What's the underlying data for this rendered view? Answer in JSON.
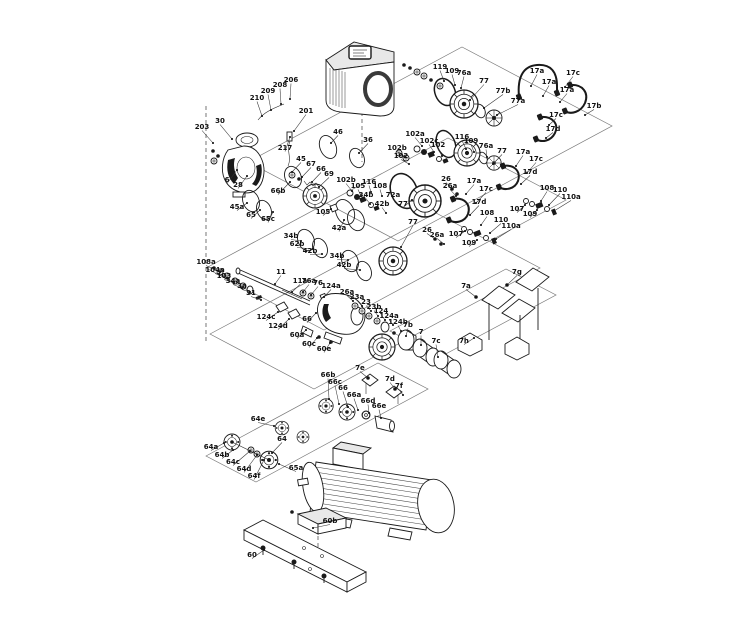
{
  "figure": {
    "type": "exploded_parts_diagram",
    "subject": "Multistage pump exploded view with numbered part callouts",
    "background": "#ffffff",
    "line_color": "#1a1a1a",
    "label_color": "#111111",
    "label_font_size": 7
  },
  "callouts": [
    {
      "t": "203",
      "x": 202,
      "y": 129,
      "lx": 213,
      "ly": 143
    },
    {
      "t": "30",
      "x": 220,
      "y": 123,
      "lx": 232,
      "ly": 139
    },
    {
      "t": "210",
      "x": 257,
      "y": 100,
      "lx": 262,
      "ly": 116
    },
    {
      "t": "209",
      "x": 268,
      "y": 93,
      "lx": 271,
      "ly": 110
    },
    {
      "t": "208",
      "x": 280,
      "y": 87,
      "lx": 281,
      "ly": 104
    },
    {
      "t": "206",
      "x": 291,
      "y": 82,
      "lx": 290,
      "ly": 99
    },
    {
      "t": "201",
      "x": 306,
      "y": 113,
      "lx": 294,
      "ly": 131
    },
    {
      "t": "217",
      "x": 285,
      "y": 150,
      "lx": 290,
      "ly": 137
    },
    {
      "t": "6",
      "x": 227,
      "y": 182,
      "lx": 237,
      "ly": 170
    },
    {
      "t": "28",
      "x": 238,
      "y": 187,
      "lx": 247,
      "ly": 176
    },
    {
      "t": "46",
      "x": 338,
      "y": 134,
      "lx": 331,
      "ly": 143
    },
    {
      "t": "36",
      "x": 368,
      "y": 142,
      "lx": 359,
      "ly": 153
    },
    {
      "t": "45",
      "x": 301,
      "y": 161,
      "lx": 292,
      "ly": 172
    },
    {
      "t": "67",
      "x": 311,
      "y": 166,
      "lx": 302,
      "ly": 177
    },
    {
      "t": "66",
      "x": 321,
      "y": 171,
      "lx": 312,
      "ly": 182
    },
    {
      "t": "69",
      "x": 329,
      "y": 176,
      "lx": 319,
      "ly": 187
    },
    {
      "t": "66b",
      "x": 278,
      "y": 193,
      "lx": 290,
      "ly": 182
    },
    {
      "t": "45a",
      "x": 237,
      "y": 209,
      "lx": 247,
      "ly": 203
    },
    {
      "t": "65",
      "x": 251,
      "y": 217,
      "lx": 260,
      "ly": 210
    },
    {
      "t": "65c",
      "x": 268,
      "y": 221,
      "lx": 273,
      "ly": 212
    },
    {
      "t": "34b",
      "x": 291,
      "y": 238,
      "lx": 301,
      "ly": 241
    },
    {
      "t": "62b",
      "x": 297,
      "y": 246,
      "lx": 313,
      "ly": 249
    },
    {
      "t": "42b",
      "x": 310,
      "y": 253,
      "lx": 322,
      "ly": 254
    },
    {
      "t": "34b",
      "x": 337,
      "y": 258,
      "lx": 348,
      "ly": 260
    },
    {
      "t": "42b",
      "x": 344,
      "y": 267,
      "lx": 360,
      "ly": 270
    },
    {
      "t": "105",
      "x": 323,
      "y": 214,
      "lx": 331,
      "ly": 209
    },
    {
      "t": "102b",
      "x": 346,
      "y": 182,
      "lx": 352,
      "ly": 191
    },
    {
      "t": "105",
      "x": 358,
      "y": 188,
      "lx": 361,
      "ly": 196
    },
    {
      "t": "116",
      "x": 369,
      "y": 184,
      "lx": 371,
      "ly": 192
    },
    {
      "t": "108",
      "x": 380,
      "y": 188,
      "lx": 382,
      "ly": 196
    },
    {
      "t": "34b",
      "x": 366,
      "y": 197,
      "lx": 370,
      "ly": 204
    },
    {
      "t": "42b",
      "x": 382,
      "y": 206,
      "lx": 386,
      "ly": 213
    },
    {
      "t": "72a",
      "x": 393,
      "y": 197,
      "lx": 399,
      "ly": 205
    },
    {
      "t": "42a",
      "x": 339,
      "y": 230,
      "lx": 344,
      "ly": 220
    },
    {
      "t": "77",
      "x": 403,
      "y": 206,
      "lx": 412,
      "ly": 200
    },
    {
      "t": "77",
      "x": 413,
      "y": 224,
      "lx": 401,
      "ly": 247
    },
    {
      "t": "26",
      "x": 446,
      "y": 181,
      "lx": 452,
      "ly": 189
    },
    {
      "t": "26a",
      "x": 450,
      "y": 188,
      "lx": 456,
      "ly": 196
    },
    {
      "t": "17a",
      "x": 474,
      "y": 183,
      "lx": 466,
      "ly": 194
    },
    {
      "t": "17c",
      "x": 486,
      "y": 191,
      "lx": 476,
      "ly": 203
    },
    {
      "t": "17d",
      "x": 479,
      "y": 204,
      "lx": 470,
      "ly": 215
    },
    {
      "t": "26",
      "x": 427,
      "y": 232,
      "lx": 435,
      "ly": 239
    },
    {
      "t": "26a",
      "x": 437,
      "y": 237,
      "lx": 444,
      "ly": 244
    },
    {
      "t": "107",
      "x": 456,
      "y": 236,
      "lx": 465,
      "ly": 231
    },
    {
      "t": "109",
      "x": 469,
      "y": 245,
      "lx": 477,
      "ly": 240
    },
    {
      "t": "108",
      "x": 487,
      "y": 215,
      "lx": 481,
      "ly": 225
    },
    {
      "t": "110",
      "x": 501,
      "y": 222,
      "lx": 490,
      "ly": 233
    },
    {
      "t": "110a",
      "x": 511,
      "y": 228,
      "lx": 496,
      "ly": 239
    },
    {
      "t": "102b",
      "x": 397,
      "y": 150,
      "lx": 405,
      "ly": 157
    },
    {
      "t": "102",
      "x": 401,
      "y": 158,
      "lx": 409,
      "ly": 164
    },
    {
      "t": "102a",
      "x": 415,
      "y": 136,
      "lx": 422,
      "ly": 146
    },
    {
      "t": "102c",
      "x": 429,
      "y": 143,
      "lx": 434,
      "ly": 152
    },
    {
      "t": "102",
      "x": 438,
      "y": 147,
      "lx": 442,
      "ly": 156
    },
    {
      "t": "116",
      "x": 462,
      "y": 139,
      "lx": 466,
      "ly": 149
    },
    {
      "t": "109",
      "x": 471,
      "y": 143,
      "lx": 474,
      "ly": 152
    },
    {
      "t": "76a",
      "x": 486,
      "y": 148,
      "lx": 487,
      "ly": 157
    },
    {
      "t": "77",
      "x": 502,
      "y": 153,
      "lx": 493,
      "ly": 164
    },
    {
      "t": "17a",
      "x": 523,
      "y": 154,
      "lx": 516,
      "ly": 166
    },
    {
      "t": "17c",
      "x": 536,
      "y": 161,
      "lx": 527,
      "ly": 173
    },
    {
      "t": "17d",
      "x": 530,
      "y": 174,
      "lx": 521,
      "ly": 184
    },
    {
      "t": "107",
      "x": 517,
      "y": 211,
      "lx": 525,
      "ly": 205
    },
    {
      "t": "109",
      "x": 530,
      "y": 216,
      "lx": 537,
      "ly": 210
    },
    {
      "t": "108",
      "x": 547,
      "y": 190,
      "lx": 541,
      "ly": 201
    },
    {
      "t": "110",
      "x": 560,
      "y": 192,
      "lx": 549,
      "ly": 205
    },
    {
      "t": "110a",
      "x": 571,
      "y": 199,
      "lx": 554,
      "ly": 211
    },
    {
      "t": "119",
      "x": 440,
      "y": 69,
      "lx": 444,
      "ly": 81
    },
    {
      "t": "109",
      "x": 452,
      "y": 73,
      "lx": 455,
      "ly": 85
    },
    {
      "t": "76a",
      "x": 464,
      "y": 75,
      "lx": 461,
      "ly": 88
    },
    {
      "t": "77",
      "x": 484,
      "y": 83,
      "lx": 470,
      "ly": 100
    },
    {
      "t": "77b",
      "x": 503,
      "y": 93,
      "lx": 484,
      "ly": 108
    },
    {
      "t": "77a",
      "x": 518,
      "y": 103,
      "lx": 497,
      "ly": 115
    },
    {
      "t": "17a",
      "x": 537,
      "y": 73,
      "lx": 531,
      "ly": 86
    },
    {
      "t": "17c",
      "x": 573,
      "y": 75,
      "lx": 565,
      "ly": 87
    },
    {
      "t": "17a",
      "x": 549,
      "y": 84,
      "lx": 543,
      "ly": 96
    },
    {
      "t": "17b",
      "x": 594,
      "y": 108,
      "lx": 585,
      "ly": 115
    },
    {
      "t": "17a",
      "x": 567,
      "y": 92,
      "lx": 560,
      "ly": 102
    },
    {
      "t": "17c",
      "x": 556,
      "y": 117,
      "lx": 549,
      "ly": 125
    },
    {
      "t": "17d",
      "x": 553,
      "y": 131,
      "lx": 546,
      "ly": 138
    },
    {
      "t": "108a",
      "x": 206,
      "y": 264,
      "lx": 220,
      "ly": 272
    },
    {
      "t": "104a",
      "x": 215,
      "y": 272,
      "lx": 227,
      "ly": 278
    },
    {
      "t": "103",
      "x": 224,
      "y": 278,
      "lx": 234,
      "ly": 283
    },
    {
      "t": "34a",
      "x": 233,
      "y": 283,
      "lx": 242,
      "ly": 288
    },
    {
      "t": "3a",
      "x": 242,
      "y": 288,
      "lx": 250,
      "ly": 292
    },
    {
      "t": "31",
      "x": 251,
      "y": 295,
      "lx": 261,
      "ly": 300
    },
    {
      "t": "11",
      "x": 281,
      "y": 274,
      "lx": 275,
      "ly": 284
    },
    {
      "t": "11a",
      "x": 300,
      "y": 283,
      "lx": 292,
      "ly": 292
    },
    {
      "t": "76a",
      "x": 309,
      "y": 283,
      "lx": 303,
      "ly": 292
    },
    {
      "t": "76",
      "x": 318,
      "y": 285,
      "lx": 311,
      "ly": 295
    },
    {
      "t": "124a",
      "x": 331,
      "y": 288,
      "lx": 324,
      "ly": 297
    },
    {
      "t": "124c",
      "x": 266,
      "y": 319,
      "lx": 278,
      "ly": 312
    },
    {
      "t": "124d",
      "x": 278,
      "y": 328,
      "lx": 289,
      "ly": 319
    },
    {
      "t": "66",
      "x": 307,
      "y": 321,
      "lx": 316,
      "ly": 313
    },
    {
      "t": "60a",
      "x": 297,
      "y": 337,
      "lx": 306,
      "ly": 330
    },
    {
      "t": "60c",
      "x": 309,
      "y": 346,
      "lx": 317,
      "ly": 338
    },
    {
      "t": "60e",
      "x": 324,
      "y": 351,
      "lx": 330,
      "ly": 343
    },
    {
      "t": "26a",
      "x": 347,
      "y": 294,
      "lx": 353,
      "ly": 301
    },
    {
      "t": "23a",
      "x": 357,
      "y": 299,
      "lx": 362,
      "ly": 306
    },
    {
      "t": "23",
      "x": 366,
      "y": 304,
      "lx": 371,
      "ly": 311
    },
    {
      "t": "23b",
      "x": 374,
      "y": 309,
      "lx": 378,
      "ly": 316
    },
    {
      "t": "124",
      "x": 381,
      "y": 313,
      "lx": 385,
      "ly": 320
    },
    {
      "t": "124a",
      "x": 389,
      "y": 318,
      "lx": 393,
      "ly": 325
    },
    {
      "t": "124b",
      "x": 398,
      "y": 324,
      "lx": 401,
      "ly": 331
    },
    {
      "t": "7b",
      "x": 408,
      "y": 327,
      "lx": 406,
      "ly": 336
    },
    {
      "t": "7",
      "x": 421,
      "y": 334,
      "lx": 421,
      "ly": 345
    },
    {
      "t": "7c",
      "x": 436,
      "y": 343,
      "lx": 438,
      "ly": 357
    },
    {
      "t": "7g",
      "x": 517,
      "y": 274,
      "lx": 507,
      "ly": 285
    },
    {
      "t": "7a",
      "x": 466,
      "y": 288,
      "lx": 476,
      "ly": 297
    },
    {
      "t": "7h",
      "x": 464,
      "y": 343,
      "lx": 474,
      "ly": 338
    },
    {
      "t": "7e",
      "x": 360,
      "y": 370,
      "lx": 368,
      "ly": 378
    },
    {
      "t": "7d",
      "x": 390,
      "y": 381,
      "lx": 395,
      "ly": 389
    },
    {
      "t": "7f",
      "x": 399,
      "y": 388,
      "lx": 403,
      "ly": 395
    },
    {
      "t": "66b",
      "x": 328,
      "y": 377,
      "lx": 329,
      "ly": 399
    },
    {
      "t": "66c",
      "x": 335,
      "y": 384,
      "lx": 339,
      "ly": 404
    },
    {
      "t": "66",
      "x": 343,
      "y": 390,
      "lx": 348,
      "ly": 407
    },
    {
      "t": "66a",
      "x": 354,
      "y": 397,
      "lx": 358,
      "ly": 410
    },
    {
      "t": "66d",
      "x": 368,
      "y": 403,
      "lx": 369,
      "ly": 413
    },
    {
      "t": "66e",
      "x": 379,
      "y": 408,
      "lx": 381,
      "ly": 418
    },
    {
      "t": "64e",
      "x": 258,
      "y": 421,
      "lx": 274,
      "ly": 426
    },
    {
      "t": "64a",
      "x": 211,
      "y": 449,
      "lx": 224,
      "ly": 443
    },
    {
      "t": "64b",
      "x": 222,
      "y": 457,
      "lx": 233,
      "ly": 450
    },
    {
      "t": "64c",
      "x": 233,
      "y": 464,
      "lx": 250,
      "ly": 451
    },
    {
      "t": "64d",
      "x": 244,
      "y": 471,
      "lx": 257,
      "ly": 455
    },
    {
      "t": "64f",
      "x": 254,
      "y": 478,
      "lx": 264,
      "ly": 460
    },
    {
      "t": "64",
      "x": 282,
      "y": 441,
      "lx": 272,
      "ly": 453
    },
    {
      "t": "65a",
      "x": 296,
      "y": 470,
      "lx": 279,
      "ly": 464
    },
    {
      "t": "60b",
      "x": 330,
      "y": 523,
      "lx": 313,
      "ly": 528
    },
    {
      "t": "60",
      "x": 252,
      "y": 557,
      "lx": 264,
      "ly": 550
    }
  ]
}
